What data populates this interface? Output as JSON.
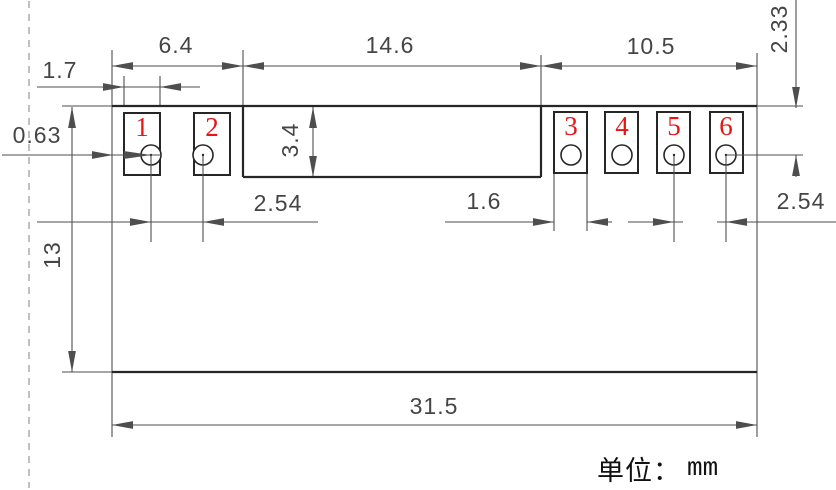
{
  "unit": {
    "prefix": "单位：",
    "value": "mm"
  },
  "colors": {
    "outline": "#262626",
    "dimension": "#4e4e4e",
    "text": "#454545",
    "pad_number": "#e81414",
    "dashed_line": "#a6a6a6",
    "background": "#ffffff"
  },
  "figure": {
    "canvas": {
      "width": 836,
      "height": 490
    },
    "dashed_line": {
      "x": 29,
      "y1": 1,
      "y2": 488
    },
    "outline_thick": [
      [
        112,
        106,
        757,
        106
      ],
      [
        112,
        372,
        757,
        372
      ],
      [
        243,
        107,
        243,
        177
      ],
      [
        243,
        177,
        541,
        177
      ],
      [
        541,
        107,
        541,
        177
      ]
    ],
    "outline_thin": [
      [
        62,
        106,
        112,
        106
      ],
      [
        62,
        372,
        112,
        372
      ],
      [
        112,
        50,
        112,
        437
      ],
      [
        757,
        53,
        757,
        437
      ],
      [
        243,
        50,
        243,
        106
      ],
      [
        541,
        55,
        541,
        106
      ],
      [
        124,
        76,
        124,
        106
      ],
      [
        160,
        76,
        160,
        106
      ],
      [
        554,
        174,
        554,
        231
      ],
      [
        587,
        174,
        587,
        231
      ],
      [
        757,
        106,
        803,
        106
      ]
    ],
    "dim_lines": [
      [
        112,
        66,
        757,
        66
      ],
      [
        37,
        87,
        200,
        87
      ],
      [
        37,
        222,
        318,
        222
      ],
      [
        313,
        107,
        313,
        177
      ],
      [
        445,
        222,
        554,
        222
      ],
      [
        587,
        222,
        612,
        222
      ],
      [
        628,
        222,
        683,
        222
      ],
      [
        717,
        222,
        836,
        222
      ],
      [
        72,
        107,
        72,
        372
      ],
      [
        112,
        425,
        757,
        425
      ],
      [
        796,
        0,
        796,
        108
      ],
      [
        796,
        155,
        796,
        177
      ]
    ],
    "overlay_lines": [
      [
        2,
        155,
        160,
        155
      ],
      [
        151,
        156,
        151,
        242
      ],
      [
        203,
        156,
        203,
        242
      ],
      [
        674,
        156,
        674,
        242
      ],
      [
        726,
        156,
        726,
        242
      ],
      [
        726,
        155,
        803,
        155
      ]
    ],
    "arrows": [
      {
        "x": 112,
        "y": 66,
        "dir": "left"
      },
      {
        "x": 243,
        "y": 66,
        "dir": "right"
      },
      {
        "x": 243,
        "y": 66,
        "dir": "left"
      },
      {
        "x": 541,
        "y": 66,
        "dir": "right"
      },
      {
        "x": 541,
        "y": 66,
        "dir": "left"
      },
      {
        "x": 757,
        "y": 66,
        "dir": "right"
      },
      {
        "x": 124,
        "y": 87,
        "dir": "right"
      },
      {
        "x": 160,
        "y": 87,
        "dir": "left"
      },
      {
        "x": 151,
        "y": 222,
        "dir": "right"
      },
      {
        "x": 203,
        "y": 222,
        "dir": "left"
      },
      {
        "x": 313,
        "y": 107,
        "dir": "up"
      },
      {
        "x": 313,
        "y": 177,
        "dir": "down"
      },
      {
        "x": 554,
        "y": 222,
        "dir": "right"
      },
      {
        "x": 587,
        "y": 222,
        "dir": "left"
      },
      {
        "x": 674,
        "y": 222,
        "dir": "right"
      },
      {
        "x": 726,
        "y": 222,
        "dir": "left"
      },
      {
        "x": 72,
        "y": 107,
        "dir": "up"
      },
      {
        "x": 72,
        "y": 372,
        "dir": "down"
      },
      {
        "x": 112,
        "y": 425,
        "dir": "left"
      },
      {
        "x": 757,
        "y": 425,
        "dir": "right"
      },
      {
        "x": 796,
        "y": 108,
        "dir": "down"
      },
      {
        "x": 796,
        "y": 155,
        "dir": "up"
      }
    ],
    "overlay_arrows": [
      {
        "x": 113,
        "y": 155,
        "dir": "right",
        "len": 21
      },
      {
        "x": 151,
        "y": 155,
        "dir": "right",
        "len": 27
      }
    ],
    "pads": [
      {
        "number": "1",
        "x": 124,
        "y": 113,
        "w": 36,
        "h": 62,
        "num_x": 142,
        "num_y": 127,
        "hole": {
          "cx": 151,
          "cy": 155,
          "r": 10,
          "dot": true
        }
      },
      {
        "number": "2",
        "x": 194,
        "y": 113,
        "w": 36,
        "h": 62,
        "num_x": 212,
        "num_y": 127,
        "hole": {
          "cx": 203,
          "cy": 155,
          "r": 10,
          "dot": true
        }
      },
      {
        "number": "3",
        "x": 554,
        "y": 112,
        "w": 33,
        "h": 61,
        "num_x": 571,
        "num_y": 126,
        "hole": {
          "cx": 571,
          "cy": 155,
          "r": 10,
          "dot": false
        }
      },
      {
        "number": "4",
        "x": 605,
        "y": 112,
        "w": 33,
        "h": 61,
        "num_x": 622,
        "num_y": 126,
        "hole": {
          "cx": 622,
          "cy": 155,
          "r": 10,
          "dot": false
        }
      },
      {
        "number": "5",
        "x": 657,
        "y": 112,
        "w": 33,
        "h": 61,
        "num_x": 674,
        "num_y": 126,
        "hole": {
          "cx": 674,
          "cy": 155,
          "r": 10,
          "dot": true
        }
      },
      {
        "number": "6",
        "x": 710,
        "y": 112,
        "w": 33,
        "h": 61,
        "num_x": 726,
        "num_y": 126,
        "hole": {
          "cx": 726,
          "cy": 155,
          "r": 10,
          "dot": true
        }
      }
    ],
    "dim_labels": [
      {
        "id": "left-section-width",
        "text": "6.4",
        "x": 176,
        "y": 45,
        "rot": 0
      },
      {
        "id": "pad1-width",
        "text": "1.7",
        "x": 60,
        "y": 70,
        "rot": 0
      },
      {
        "id": "center-section-width",
        "text": "14.6",
        "x": 390,
        "y": 45,
        "rot": 0
      },
      {
        "id": "right-section-width",
        "text": "10.5",
        "x": 651,
        "y": 46,
        "rot": 0
      },
      {
        "id": "hole-offset-from-top",
        "text": "2.33",
        "x": 779,
        "y": 29,
        "rot": -90
      },
      {
        "id": "pad-inset-from-left-edge",
        "text": "0.63",
        "x": 37,
        "y": 135,
        "rot": 0
      },
      {
        "id": "center-section-height",
        "text": "3.4",
        "x": 290,
        "y": 140,
        "rot": -90
      },
      {
        "id": "body-height",
        "text": "13",
        "x": 52,
        "y": 255,
        "rot": -90
      },
      {
        "id": "hole-pitch-left",
        "text": "2.54",
        "x": 278,
        "y": 203,
        "rot": 0
      },
      {
        "id": "pad3-width",
        "text": "1.6",
        "x": 484,
        "y": 201,
        "rot": 0
      },
      {
        "id": "hole-pitch-right",
        "text": "2.54",
        "x": 801,
        "y": 201,
        "rot": 0
      },
      {
        "id": "overall-width",
        "text": "31.5",
        "x": 434,
        "y": 406,
        "rot": 0
      }
    ]
  }
}
